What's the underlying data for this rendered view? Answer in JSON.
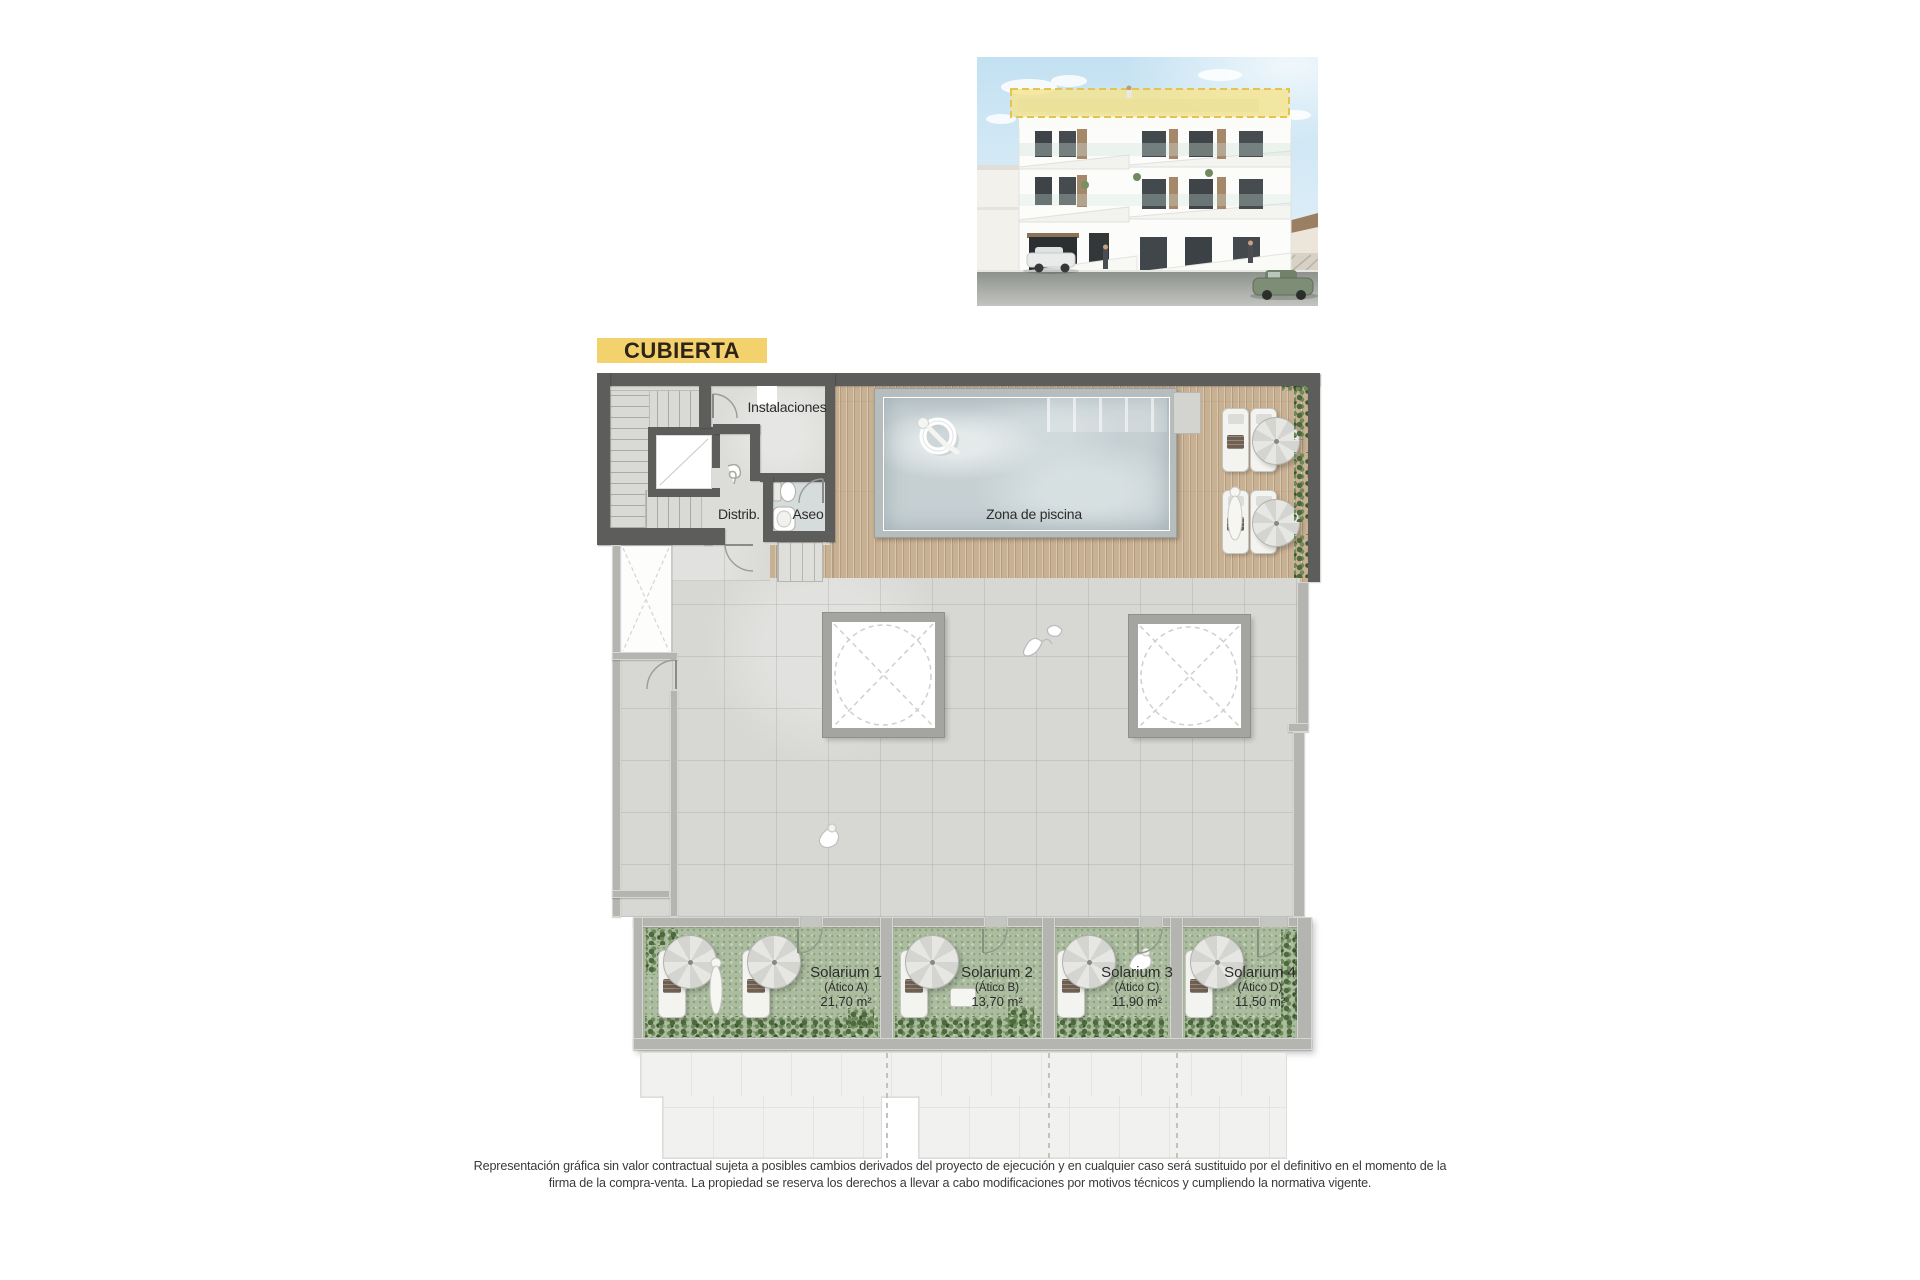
{
  "badge": {
    "label": "CUBIERTA"
  },
  "plan": {
    "labels": {
      "instalaciones": "Instalaciones",
      "distrib": "Distrib.",
      "aseo": "Aseo",
      "pool": "Zona de piscina"
    },
    "solariums": [
      {
        "name": "Solarium 1",
        "unit": "(Ático A)",
        "area": "21,70 m²"
      },
      {
        "name": "Solarium 2",
        "unit": "(Ático B)",
        "area": "13,70 m²"
      },
      {
        "name": "Solarium 3",
        "unit": "(Ático C)",
        "area": "11,90 m²"
      },
      {
        "name": "Solarium 4",
        "unit": "(Ático D)",
        "area": "11,50 m²"
      }
    ]
  },
  "disclaimer": {
    "line1": "Representación gráfica sin valor contractual sujeta a posibles cambios derivados del proyecto de ejecución y en cualquier caso será sustituido por el definitivo en el momento de la",
    "line2": "firma de la compra-venta. La propiedad se reserva los derechos a llevar a cabo modificaciones por motivos técnicos y cumpliendo la normativa vigente."
  },
  "colors": {
    "accent_yellow": "#f3d26e",
    "wall_dark": "#5d5e5c",
    "wall_light": "#b4b5b1",
    "wood_deck": "#c8b092",
    "pool_water": "#c6d0d3",
    "terrace": "#d7d8d4",
    "grass": "#abbc9f"
  }
}
